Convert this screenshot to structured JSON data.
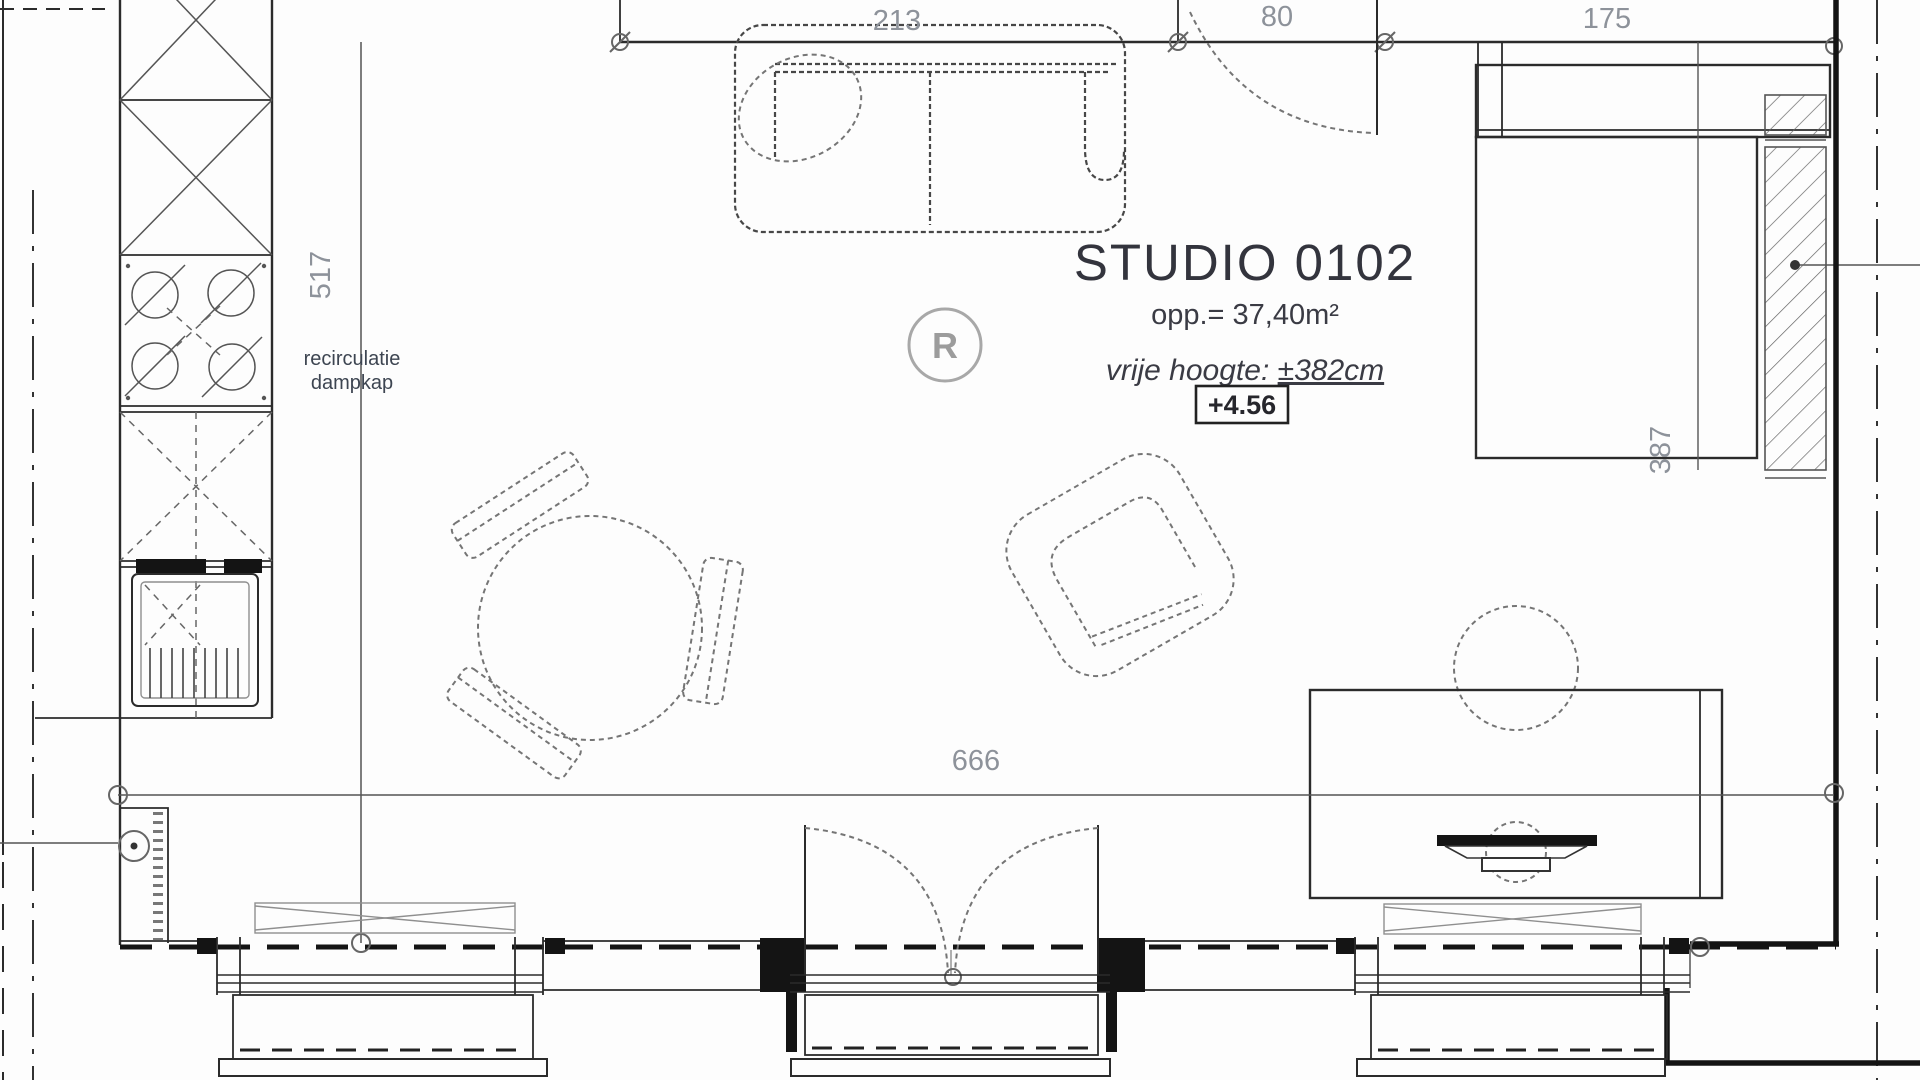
{
  "plan": {
    "title": "STUDIO 0102",
    "area_label": "opp.= 37,40m²",
    "height_label_prefix": "vrije hoogte: ",
    "height_label_value": "±382cm",
    "level_marker": "+4.56",
    "kitchen_note_line1": "recirculatie",
    "kitchen_note_line2": "dampkap",
    "detector_symbol": "R",
    "dimensions": {
      "sofa_wall": "213",
      "entrance_door": "80",
      "bed_wall": "175",
      "kitchen_side": "517",
      "bed_side": "387",
      "room_width": "666"
    },
    "colors": {
      "line": "#2b2b2b",
      "wall": "#141414",
      "dim_text": "#8d929a",
      "title_text": "#33343d",
      "furniture_dash": "#757575"
    }
  }
}
